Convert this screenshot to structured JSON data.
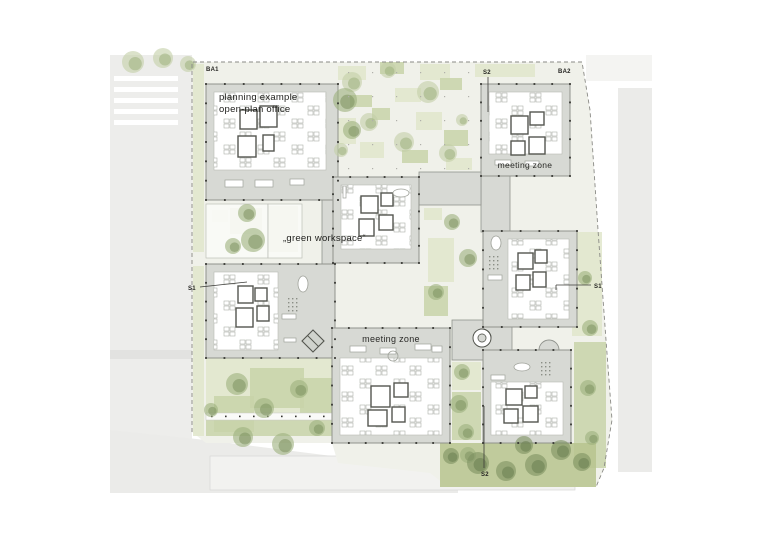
{
  "plan": {
    "type": "architectural-site-plan",
    "labels": {
      "ba1": "BA1",
      "s2_top": "S2",
      "ba2": "BA2",
      "planning_line1": "planning example",
      "planning_line2": "open-plan office",
      "meeting_zone_top": "meeting zone",
      "green_workspace": "„green workspace“",
      "s1_left": "S1",
      "s1_right": "S1",
      "meeting_zone_bottom": "meeting zone",
      "s2_bottom": "S2"
    },
    "colors": {
      "paper": "#ffffff",
      "ground": "#f0f1ea",
      "road": "#ededeb",
      "road_band": "#e2e2e0",
      "plaza": "#ebebe9",
      "context_building": "#f2f2f0",
      "neighbor": "#ebebe9",
      "band": "#d7d9d4",
      "outline": "#90938d",
      "interior": "#ffffff",
      "core": "#54564f",
      "furniture": "#9fa29a",
      "green_light": "#e0e6cb",
      "green_mid": "#c8d4a9",
      "lawn": "#b7c48e",
      "tree_light": "#c3cea6",
      "tree": "#9db17d",
      "tree_dark": "#7d9160",
      "boundary": "#8a8a85",
      "dot": "#33332f",
      "text": "#262623"
    },
    "geometry": {
      "ground_polygon": "192,62 582,62 590,110 598,230 606,340 612,420 604,468 596,487 448,487 430,473 338,463 332,443 206,443 192,432",
      "boundary_polyline": "192,432 192,62 582,62 590,110 598,230 606,340 612,420 604,468 596,487",
      "context": {
        "road": [
          110,
          55,
          82,
          425
        ],
        "road_band": [
          110,
          350,
          82,
          9
        ],
        "crosswalk": [
          [
            114,
            76,
            64,
            5
          ],
          [
            114,
            87,
            64,
            5
          ],
          [
            114,
            98,
            64,
            5
          ],
          [
            114,
            109,
            64,
            5
          ],
          [
            114,
            120,
            64,
            5
          ]
        ],
        "plaza_polygon": "110,430 206,440 332,456 445,473 458,480 458,493 110,493",
        "context_building": [
          210,
          456,
          365,
          34
        ],
        "neighbor_east": [
          618,
          88,
          34,
          384
        ],
        "block_northeast": [
          586,
          55,
          66,
          26
        ]
      },
      "buildings": [
        {
          "name": "open-plan-office-block",
          "x": 206,
          "y": 84,
          "w": 132,
          "h": 116,
          "inner": [
            8,
            8,
            112,
            78
          ],
          "cores": [
            [
              34,
              26,
              17,
              19
            ],
            [
              54,
              22,
              17,
              21
            ],
            [
              32,
              52,
              18,
              21
            ],
            [
              57,
              51,
              11,
              16
            ]
          ],
          "furn": [
            [
              19,
              96,
              18,
              7
            ],
            [
              49,
              96,
              18,
              7
            ],
            [
              84,
              95,
              14,
              6
            ]
          ],
          "stair": [
            101,
            95,
            17,
            18
          ]
        },
        {
          "name": "meeting-zone-north-block",
          "x": 481,
          "y": 84,
          "w": 89,
          "h": 92,
          "inner": [
            8,
            8,
            73,
            62
          ],
          "cores": [
            [
              30,
              32,
              17,
              18
            ],
            [
              49,
              28,
              14,
              13
            ],
            [
              30,
              57,
              14,
              14
            ],
            [
              48,
              53,
              16,
              17
            ]
          ],
          "furn": [
            [
              14,
              76,
              16,
              5
            ],
            [
              44,
              77,
              14,
              5
            ]
          ]
        },
        {
          "name": "west-office-block",
          "x": 206,
          "y": 264,
          "w": 129,
          "h": 94,
          "inner": [
            8,
            8,
            64,
            78
          ],
          "cores": [
            [
              32,
              22,
              15,
              17
            ],
            [
              49,
              24,
              12,
              13
            ],
            [
              30,
              44,
              17,
              19
            ],
            [
              51,
              42,
              12,
              15
            ]
          ],
          "furn": [
            [
              76,
              50,
              14,
              5
            ],
            [
              78,
              74,
              12,
              4
            ]
          ],
          "ellipse": [
            97,
            20,
            5,
            8
          ],
          "dots": [
            82,
            34
          ],
          "diamond": [
            107,
            77,
            11
          ]
        },
        {
          "name": "green-workspace-block",
          "x": 333,
          "y": 177,
          "w": 86,
          "h": 86,
          "inner": [
            8,
            8,
            70,
            64
          ],
          "cores": [
            [
              28,
              19,
              17,
              17
            ],
            [
              48,
              16,
              12,
              13
            ],
            [
              26,
              42,
              15,
              17
            ],
            [
              46,
              38,
              14,
              15
            ]
          ],
          "furn": [
            [
              10,
              9,
              3,
              12
            ]
          ],
          "ellipse": [
            68,
            16,
            8,
            4
          ]
        },
        {
          "name": "east-office-block",
          "x": 483,
          "y": 231,
          "w": 94,
          "h": 96,
          "inner": [
            25,
            8,
            61,
            80
          ],
          "cores": [
            [
              35,
              22,
              15,
              16
            ],
            [
              52,
              19,
              12,
              13
            ],
            [
              33,
              44,
              14,
              15
            ],
            [
              50,
              41,
              13,
              15
            ]
          ],
          "furn": [
            [
              5,
              44,
              14,
              5
            ]
          ],
          "ellipse": [
            13,
            12,
            5,
            7
          ],
          "dots": [
            6,
            25
          ]
        },
        {
          "name": "meeting-zone-south-block",
          "x": 332,
          "y": 328,
          "w": 118,
          "h": 115,
          "inner": [
            8,
            30,
            102,
            77
          ],
          "cores": [
            [
              39,
              58,
              19,
              21
            ],
            [
              62,
              55,
              14,
              14
            ],
            [
              36,
              82,
              19,
              16
            ],
            [
              60,
              79,
              13,
              15
            ]
          ],
          "furn": [
            [
              18,
              18,
              16,
              6
            ],
            [
              48,
              20,
              16,
              6
            ],
            [
              83,
              16,
              16,
              6
            ],
            [
              100,
              18,
              10,
              6
            ]
          ],
          "circle": [
            61,
            28,
            5
          ]
        },
        {
          "name": "southeast-office-block",
          "x": 483,
          "y": 350,
          "w": 88,
          "h": 93,
          "inner": [
            8,
            32,
            72,
            53
          ],
          "cores": [
            [
              23,
              39,
              16,
              16
            ],
            [
              42,
              36,
              12,
              12
            ],
            [
              21,
              59,
              14,
              14
            ],
            [
              40,
              56,
              15,
              16
            ]
          ],
          "furn": [
            [
              8,
              25,
              14,
              5
            ]
          ],
          "ellipse": [
            39,
            17,
            8,
            4
          ],
          "dots": [
            58,
            12
          ],
          "dome": [
            56,
            0,
            10
          ]
        }
      ],
      "connectors": [
        [
          322,
          200,
          12,
          65
        ],
        [
          481,
          176,
          29,
          56
        ],
        [
          419,
          172,
          62,
          33
        ],
        [
          452,
          320,
          60,
          40
        ]
      ],
      "spiral_stair": [
        482,
        338,
        9
      ],
      "paddocks": [
        [
          206,
          204,
          62,
          54
        ],
        [
          268,
          204,
          34,
          54
        ]
      ],
      "pergola": [
        206,
        413,
        126,
        7
      ],
      "patches": [
        [
          338,
          66,
          28,
          14,
          "L"
        ],
        [
          380,
          62,
          24,
          12,
          "M"
        ],
        [
          420,
          64,
          30,
          16,
          "L"
        ],
        [
          350,
          95,
          22,
          12,
          "M"
        ],
        [
          395,
          88,
          26,
          14,
          "L"
        ],
        [
          440,
          78,
          22,
          12,
          "M"
        ],
        [
          336,
          118,
          20,
          26,
          "L"
        ],
        [
          372,
          108,
          18,
          12,
          "M"
        ],
        [
          416,
          112,
          26,
          18,
          "L"
        ],
        [
          444,
          130,
          24,
          16,
          "M"
        ],
        [
          360,
          142,
          24,
          16,
          "L"
        ],
        [
          402,
          150,
          26,
          13,
          "M"
        ],
        [
          446,
          158,
          26,
          12,
          "L"
        ],
        [
          475,
          64,
          60,
          13,
          "L"
        ],
        [
          193,
          64,
          11,
          188,
          "L"
        ],
        [
          193,
          266,
          11,
          170,
          "L"
        ],
        [
          230,
          208,
          32,
          26,
          "M"
        ],
        [
          268,
          206,
          30,
          46,
          "M"
        ],
        [
          212,
          210,
          16,
          12,
          "L"
        ],
        [
          424,
          208,
          18,
          12,
          "L"
        ],
        [
          428,
          238,
          26,
          44,
          "L"
        ],
        [
          424,
          286,
          24,
          30,
          "M"
        ],
        [
          572,
          232,
          30,
          104,
          "L"
        ],
        [
          574,
          342,
          32,
          126,
          "M"
        ],
        [
          206,
          358,
          126,
          62,
          "L"
        ],
        [
          250,
          368,
          54,
          40,
          "M"
        ],
        [
          300,
          378,
          32,
          40,
          "M"
        ],
        [
          214,
          396,
          40,
          36,
          "M"
        ],
        [
          206,
          420,
          126,
          16,
          "M"
        ],
        [
          452,
          362,
          29,
          28,
          "L"
        ],
        [
          452,
          392,
          29,
          48,
          "M"
        ],
        [
          440,
          443,
          156,
          44,
          "LAWN"
        ]
      ],
      "trees": [
        [
          345,
          100,
          12
        ],
        [
          352,
          130,
          9
        ],
        [
          247,
          213,
          9
        ],
        [
          233,
          246,
          8
        ],
        [
          253,
          240,
          12
        ],
        [
          452,
          222,
          8
        ],
        [
          468,
          258,
          9
        ],
        [
          436,
          292,
          8
        ],
        [
          237,
          384,
          11
        ],
        [
          264,
          408,
          10
        ],
        [
          299,
          389,
          9
        ],
        [
          243,
          437,
          10
        ],
        [
          283,
          444,
          11
        ],
        [
          317,
          428,
          8
        ],
        [
          211,
          410,
          7
        ],
        [
          462,
          372,
          8
        ],
        [
          459,
          404,
          9
        ],
        [
          466,
          432,
          8
        ],
        [
          468,
          455,
          8
        ],
        [
          585,
          278,
          7
        ],
        [
          590,
          328,
          8
        ],
        [
          588,
          388,
          8
        ],
        [
          592,
          438,
          7
        ]
      ],
      "trees_light": [
        [
          352,
          82,
          10
        ],
        [
          388,
          70,
          8
        ],
        [
          428,
          92,
          11
        ],
        [
          369,
          122,
          9
        ],
        [
          404,
          142,
          10
        ],
        [
          448,
          153,
          9
        ],
        [
          341,
          150,
          7
        ],
        [
          462,
          120,
          6
        ],
        [
          133,
          62,
          11
        ],
        [
          163,
          58,
          10
        ],
        [
          188,
          64,
          8
        ]
      ],
      "trees_dark": [
        [
          478,
          463,
          11
        ],
        [
          506,
          471,
          10
        ],
        [
          536,
          465,
          11
        ],
        [
          561,
          450,
          10
        ],
        [
          524,
          445,
          9
        ],
        [
          582,
          462,
          9
        ],
        [
          451,
          456,
          8
        ]
      ],
      "leaders": [
        [
          488,
          77,
          488,
          112
        ],
        [
          200,
          287,
          247,
          282
        ],
        [
          556,
          285,
          591,
          285
        ],
        [
          556,
          285,
          556,
          290
        ],
        [
          484,
          406,
          484,
          468
        ]
      ],
      "courtyard_dots": {
        "x0": 348,
        "x1": 472,
        "y0": 72,
        "y1": 168,
        "step": 24
      }
    }
  }
}
